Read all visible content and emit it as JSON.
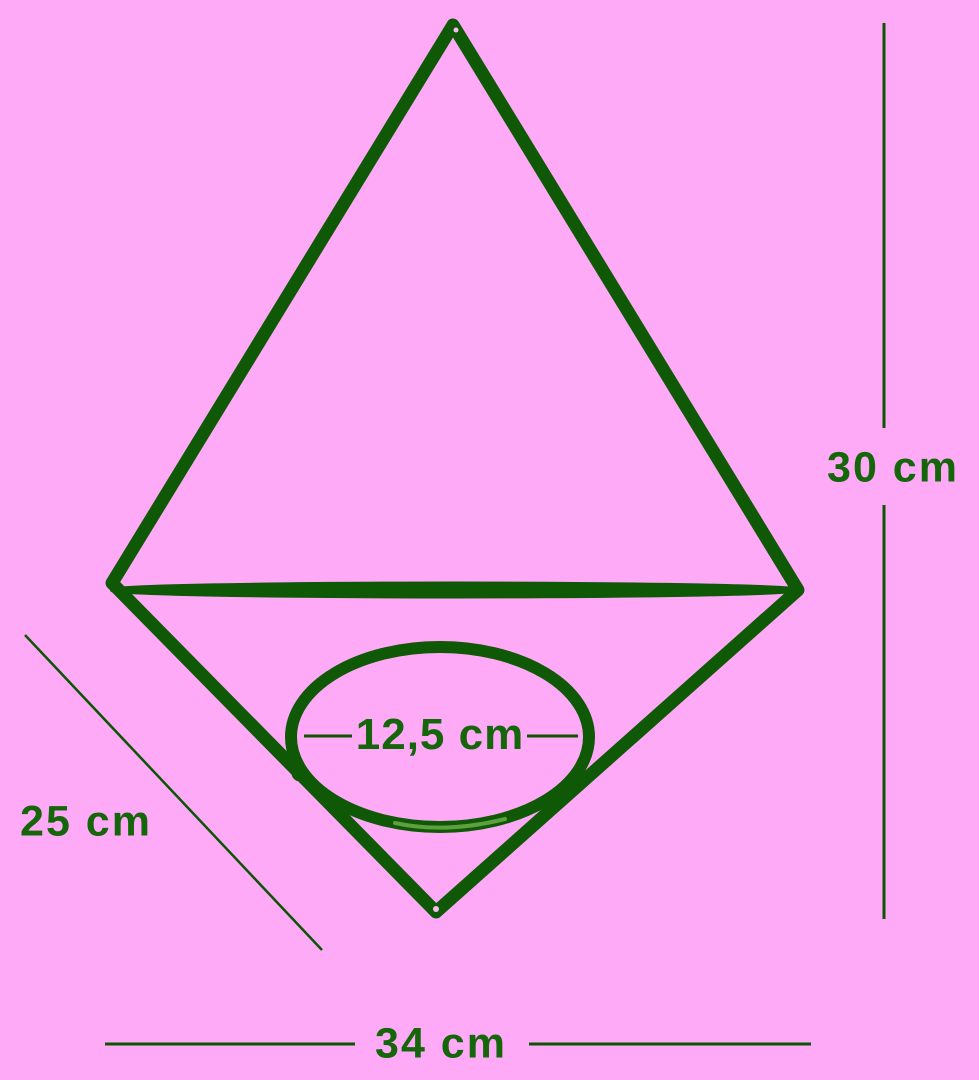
{
  "diagram": {
    "type": "product-dimension-diagram",
    "subject": "geometric wire hanging planter frame with pot ring",
    "labels": {
      "overall_height": "30 cm",
      "side_edge": "25 cm",
      "overall_width": "34 cm",
      "ring_diameter": "12,5 cm"
    },
    "dimension_lines": [
      {
        "name": "overall-height",
        "orientation": "vertical",
        "value": "30 cm"
      },
      {
        "name": "side-edge",
        "orientation": "diagonal",
        "value": "25 cm"
      },
      {
        "name": "overall-width",
        "orientation": "horizontal",
        "value": "34 cm"
      },
      {
        "name": "ring-diameter",
        "orientation": "horizontal-leader",
        "value": "12,5 cm"
      }
    ]
  },
  "colors": {
    "background": "#feaaf7",
    "wire": "#0e5806",
    "dimline": "#0a5404",
    "text": "#15650a",
    "sheen": "#66a845",
    "glint": "#f9bdf2"
  }
}
